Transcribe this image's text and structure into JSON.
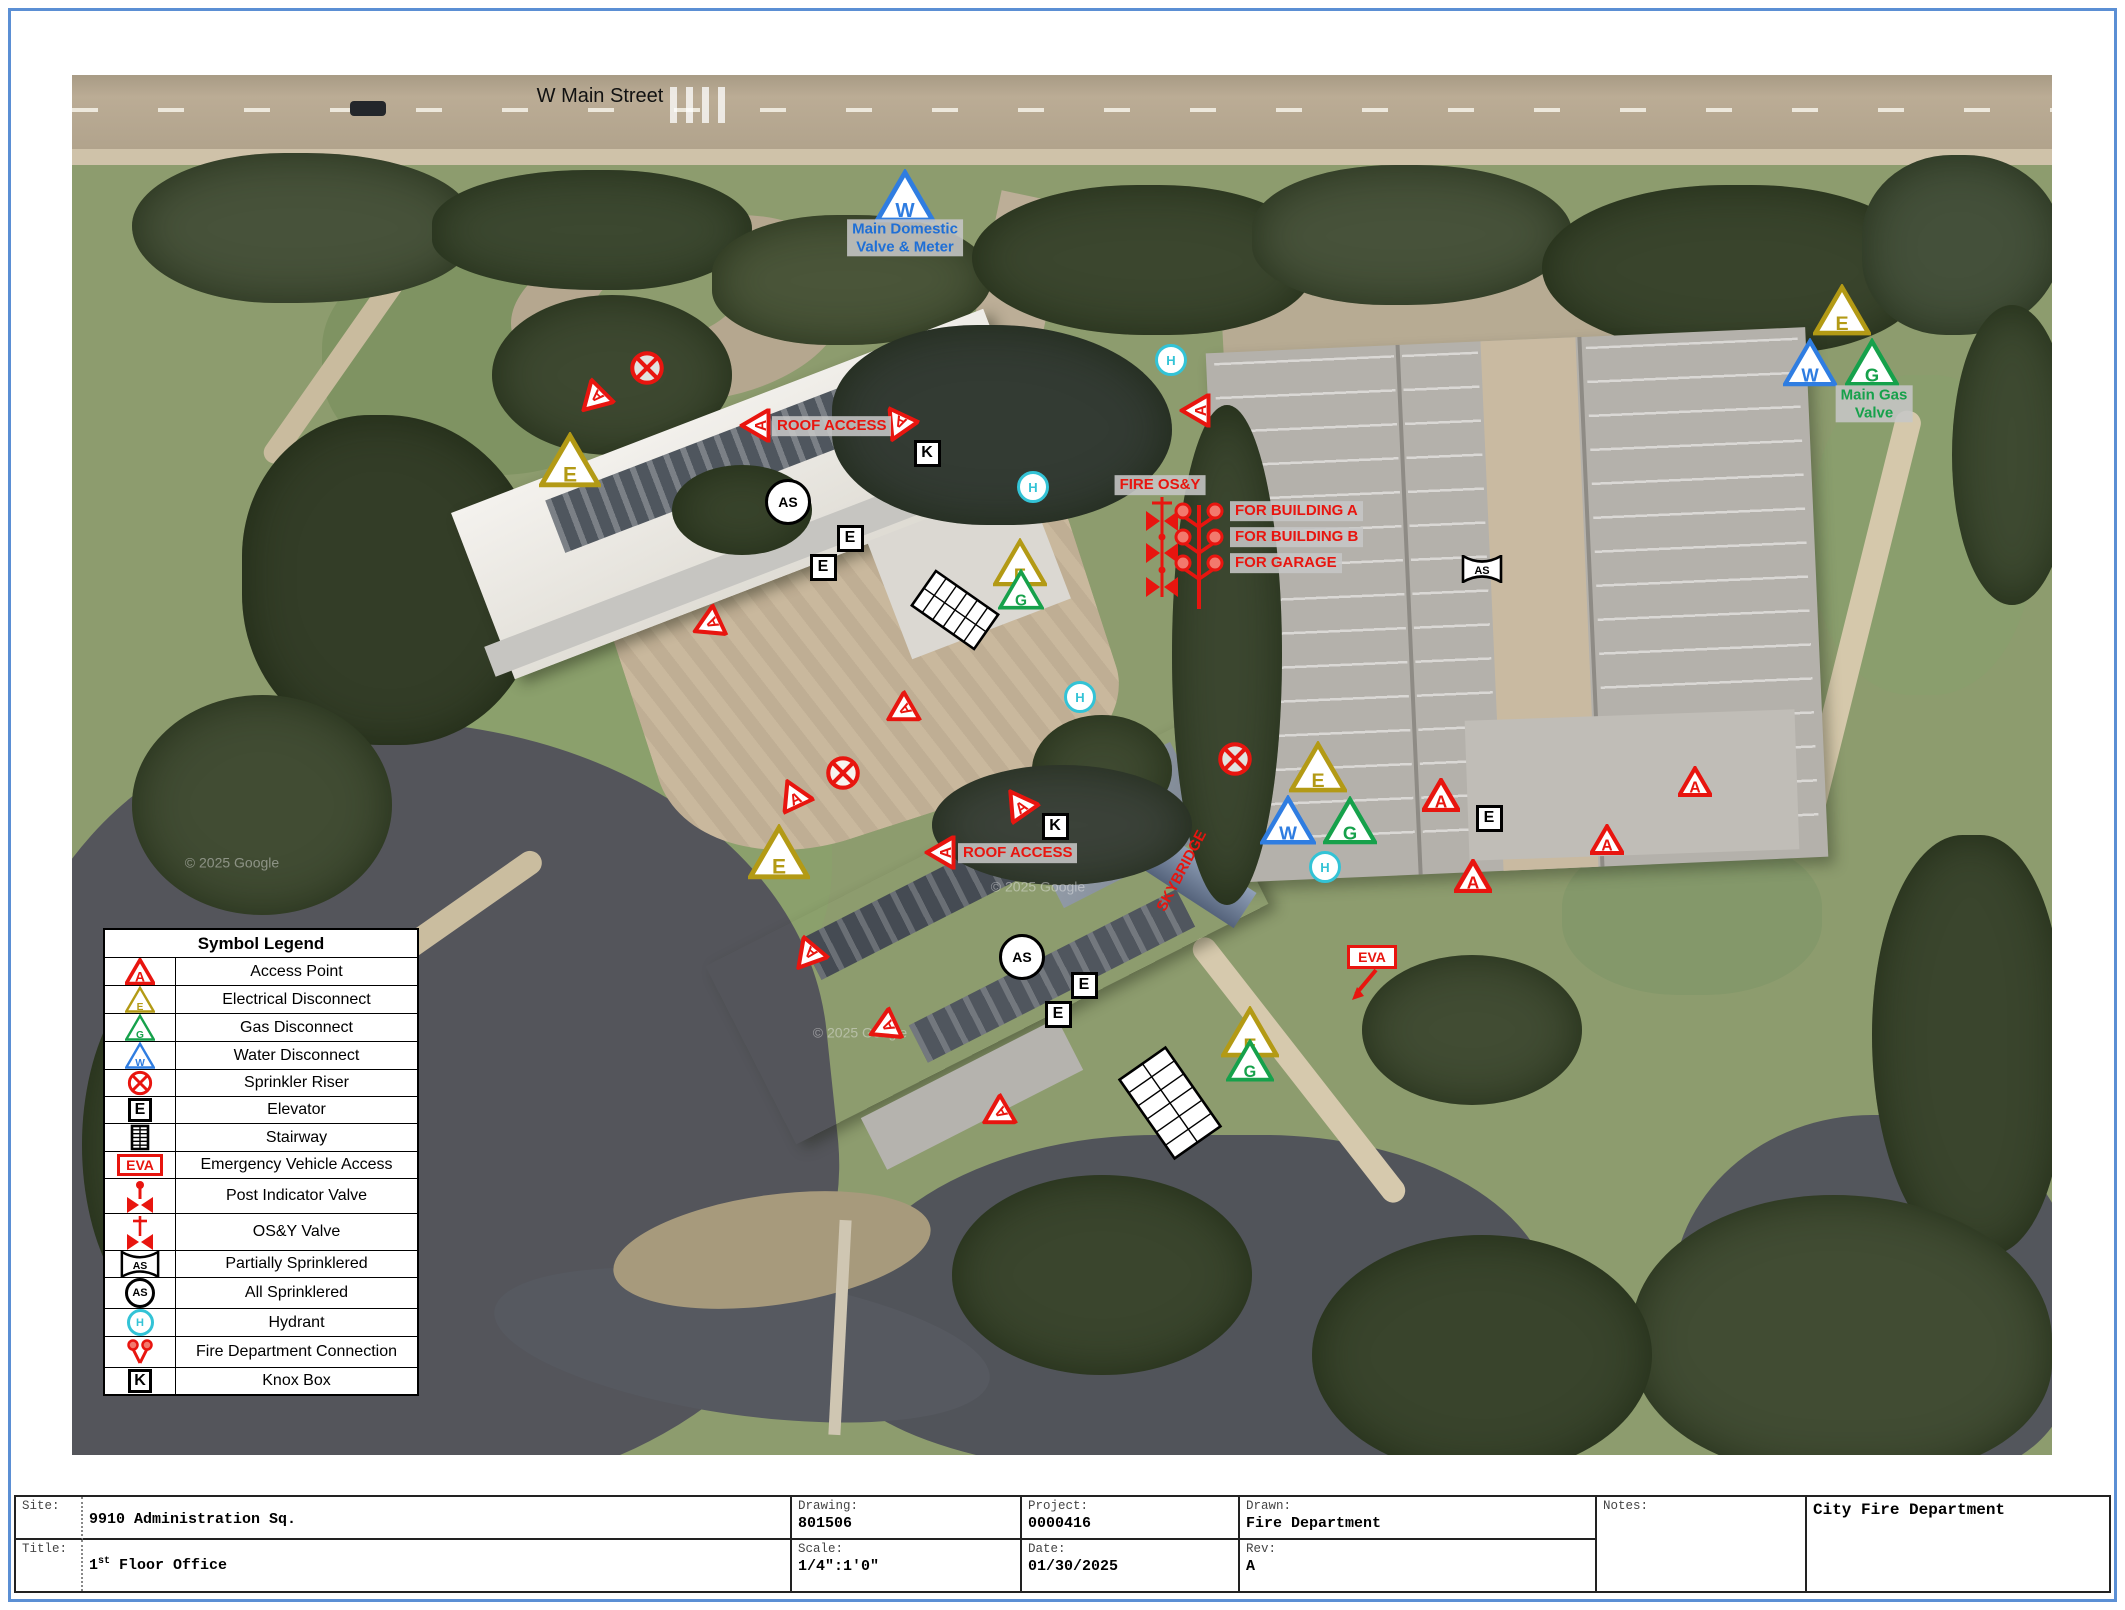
{
  "street": {
    "label": "W Main Street"
  },
  "legend": {
    "title": "Symbol Legend",
    "rows": [
      {
        "icon": "tri",
        "letter": "A",
        "color": "red",
        "label": "Access Point"
      },
      {
        "icon": "tri",
        "letter": "E",
        "color": "yellow",
        "label": "Electrical Disconnect"
      },
      {
        "icon": "tri",
        "letter": "G",
        "color": "green",
        "label": "Gas Disconnect"
      },
      {
        "icon": "tri",
        "letter": "W",
        "color": "blue",
        "label": "Water Disconnect"
      },
      {
        "icon": "riser",
        "label": "Sprinkler Riser"
      },
      {
        "icon": "box",
        "letter": "E",
        "label": "Elevator"
      },
      {
        "icon": "stair",
        "label": "Stairway"
      },
      {
        "icon": "eva",
        "letter": "EVA",
        "label": "Emergency Vehicle Access"
      },
      {
        "icon": "piv",
        "label": "Post Indicator Valve"
      },
      {
        "icon": "osy",
        "label": "OS&Y Valve"
      },
      {
        "icon": "bowtieAS",
        "letter": "AS",
        "label": "Partially Sprinklered"
      },
      {
        "icon": "circleAS",
        "letter": "AS",
        "label": "All Sprinklered"
      },
      {
        "icon": "hyd",
        "letter": "H",
        "label": "Hydrant"
      },
      {
        "icon": "fdc",
        "label": "Fire Department Connection"
      },
      {
        "icon": "box",
        "letter": "K",
        "label": "Knox Box"
      }
    ]
  },
  "map": {
    "colors": {
      "red": "#e8150f",
      "yellow": "#b39a15",
      "green": "#16a14b",
      "blue": "#2f7de1",
      "cyan": "#33c3d6",
      "label_blue": "#1f6fd6",
      "label_bg": "#c6c6c6",
      "black": "#111111",
      "wm": "rgba(235,235,235,0.45)"
    },
    "markers": [
      {
        "t": "tri",
        "l": "W",
        "c": "blue",
        "x": 833,
        "y": 121,
        "s": 60
      },
      {
        "t": "hyd",
        "l": "H",
        "x": 1099,
        "y": 285
      },
      {
        "t": "tri",
        "l": "A",
        "c": "red",
        "x": 1123,
        "y": 335,
        "s": 34,
        "r": -90
      },
      {
        "t": "riser",
        "x": 575,
        "y": 293
      },
      {
        "t": "tri",
        "l": "A",
        "c": "red",
        "x": 521,
        "y": 325,
        "s": 34,
        "r": -135
      },
      {
        "t": "tri",
        "l": "E",
        "c": "yellow",
        "x": 498,
        "y": 385,
        "s": 62
      },
      {
        "t": "tri",
        "l": "A",
        "c": "red",
        "x": 683,
        "y": 350,
        "s": 34,
        "r": -90
      },
      {
        "t": "tri",
        "l": "A",
        "c": "red",
        "x": 826,
        "y": 352,
        "s": 34,
        "r": -155
      },
      {
        "t": "box",
        "l": "K",
        "x": 855,
        "y": 378
      },
      {
        "t": "circleAS",
        "l": "AS",
        "x": 716,
        "y": 427
      },
      {
        "t": "hyd",
        "l": "H",
        "x": 961,
        "y": 412
      },
      {
        "t": "box",
        "l": "E",
        "x": 778,
        "y": 463
      },
      {
        "t": "box",
        "l": "E",
        "x": 751,
        "y": 492
      },
      {
        "t": "tri",
        "l": "E",
        "c": "yellow",
        "x": 948,
        "y": 487,
        "s": 54
      },
      {
        "t": "tri",
        "l": "G",
        "c": "green",
        "x": 949,
        "y": 514,
        "s": 46
      },
      {
        "t": "stair",
        "x": 883,
        "y": 535,
        "w": 46,
        "h": 80,
        "r": -55
      },
      {
        "t": "tri",
        "l": "A",
        "c": "red",
        "x": 635,
        "y": 550,
        "s": 34,
        "r": -115
      },
      {
        "t": "hyd",
        "l": "H",
        "x": 1008,
        "y": 622
      },
      {
        "t": "tri",
        "l": "A",
        "c": "red",
        "x": 828,
        "y": 637,
        "s": 34,
        "r": -120
      },
      {
        "t": "fireosy",
        "x": 1090,
        "y": 472
      },
      {
        "t": "fdctree",
        "x": 1127,
        "y": 482
      },
      {
        "t": "bowtieAS",
        "l": "AS",
        "x": 1410,
        "y": 494
      },
      {
        "t": "riser",
        "x": 1163,
        "y": 684
      },
      {
        "t": "tri",
        "l": "E",
        "c": "yellow",
        "x": 1246,
        "y": 692,
        "s": 58
      },
      {
        "t": "tri",
        "l": "W",
        "c": "blue",
        "x": 1216,
        "y": 745,
        "s": 56
      },
      {
        "t": "tri",
        "l": "G",
        "c": "green",
        "x": 1278,
        "y": 745,
        "s": 54
      },
      {
        "t": "tri",
        "l": "A",
        "c": "red",
        "x": 1369,
        "y": 720,
        "s": 38
      },
      {
        "t": "box",
        "l": "E",
        "x": 1417,
        "y": 743
      },
      {
        "t": "tri",
        "l": "A",
        "c": "red",
        "x": 1623,
        "y": 706,
        "s": 34
      },
      {
        "t": "tri",
        "l": "A",
        "c": "red",
        "x": 1535,
        "y": 764,
        "s": 34
      },
      {
        "t": "tri",
        "l": "A",
        "c": "red",
        "x": 1401,
        "y": 801,
        "s": 38
      },
      {
        "t": "hyd",
        "l": "H",
        "x": 1253,
        "y": 792
      },
      {
        "t": "eva",
        "l": "EVA",
        "x": 1300,
        "y": 882
      },
      {
        "t": "tri",
        "l": "E",
        "c": "yellow",
        "x": 1770,
        "y": 235,
        "s": 58
      },
      {
        "t": "tri",
        "l": "W",
        "c": "blue",
        "x": 1738,
        "y": 287,
        "s": 54
      },
      {
        "t": "tri",
        "l": "G",
        "c": "green",
        "x": 1800,
        "y": 287,
        "s": 54
      },
      {
        "t": "riser",
        "x": 771,
        "y": 698
      },
      {
        "t": "tri",
        "l": "A",
        "c": "red",
        "x": 721,
        "y": 718,
        "s": 34,
        "r": -25
      },
      {
        "t": "tri",
        "l": "A",
        "c": "red",
        "x": 946,
        "y": 727,
        "s": 34,
        "r": -35
      },
      {
        "t": "box",
        "l": "K",
        "x": 983,
        "y": 751
      },
      {
        "t": "tri",
        "l": "A",
        "c": "red",
        "x": 868,
        "y": 777,
        "s": 34,
        "r": -90
      },
      {
        "t": "tri",
        "l": "E",
        "c": "yellow",
        "x": 707,
        "y": 777,
        "s": 62
      },
      {
        "t": "circleAS",
        "l": "AS",
        "x": 950,
        "y": 882
      },
      {
        "t": "tri",
        "l": "A",
        "c": "red",
        "x": 735,
        "y": 882,
        "s": 34,
        "r": -140
      },
      {
        "t": "box",
        "l": "E",
        "x": 1012,
        "y": 910
      },
      {
        "t": "box",
        "l": "E",
        "x": 986,
        "y": 939
      },
      {
        "t": "tri",
        "l": "A",
        "c": "red",
        "x": 811,
        "y": 953,
        "s": 34,
        "r": -115
      },
      {
        "t": "tri",
        "l": "A",
        "c": "red",
        "x": 924,
        "y": 1040,
        "s": 34,
        "r": -120
      },
      {
        "t": "tri",
        "l": "E",
        "c": "yellow",
        "x": 1178,
        "y": 957,
        "s": 58
      },
      {
        "t": "tri",
        "l": "G",
        "c": "green",
        "x": 1178,
        "y": 985,
        "s": 48
      },
      {
        "t": "stair",
        "x": 1098,
        "y": 1028,
        "w": 60,
        "h": 100,
        "r": -35
      }
    ],
    "labels": [
      {
        "name": "street-name-label",
        "text": "W Main Street",
        "x": 528,
        "y": 22,
        "cls": "street",
        "color": "black"
      },
      {
        "name": "main-domestic-valve-label",
        "lines": [
          "Main Domestic",
          "Valve & Meter"
        ],
        "x": 833,
        "y": 163,
        "color": "label_blue",
        "bg": true
      },
      {
        "name": "fire-osy-label",
        "text": "FIRE OS&Y",
        "x": 1088,
        "y": 410,
        "color": "red",
        "bg": true
      },
      {
        "name": "fdc-building-a-label",
        "text": "FOR BUILDING A",
        "x": 1158,
        "y": 436,
        "color": "red",
        "bg": true,
        "align": "left"
      },
      {
        "name": "fdc-building-b-label",
        "text": "FOR BUILDING B",
        "x": 1158,
        "y": 462,
        "color": "red",
        "bg": true,
        "align": "left"
      },
      {
        "name": "fdc-garage-label",
        "text": "FOR GARAGE",
        "x": 1158,
        "y": 488,
        "color": "red",
        "bg": true,
        "align": "left"
      },
      {
        "name": "roof-access-label-a",
        "text": "ROOF ACCESS",
        "x": 700,
        "y": 351,
        "color": "red",
        "bg": true,
        "align": "left"
      },
      {
        "name": "roof-access-label-b",
        "text": "ROOF ACCESS",
        "x": 886,
        "y": 778,
        "color": "red",
        "bg": true,
        "align": "left"
      },
      {
        "name": "skybridge-label",
        "text": "SKYBRIDGE",
        "x": 1110,
        "y": 796,
        "color": "red",
        "rot": -62
      },
      {
        "name": "main-gas-valve-label",
        "lines": [
          "Main Gas",
          "Valve"
        ],
        "x": 1802,
        "y": 329,
        "color": "green",
        "bg": true
      },
      {
        "name": "google-watermark",
        "text": "© 2025 Google",
        "x": 160,
        "y": 788,
        "cls": "wm",
        "color": "wm"
      },
      {
        "name": "google-watermark",
        "text": "© 2025 Google",
        "x": 966,
        "y": 812,
        "cls": "wm",
        "color": "wm"
      },
      {
        "name": "google-watermark",
        "text": "© 2025 Google",
        "x": 788,
        "y": 958,
        "cls": "wm",
        "color": "wm"
      }
    ]
  },
  "title_block": {
    "site_label": "Site:",
    "site_value": "9910 Administration Sq.",
    "title_label": "Title:",
    "title_value": {
      "num": "1",
      "sup": "st",
      "rest": " Floor Office"
    },
    "drawing_label": "Drawing:",
    "drawing_value": "801506",
    "scale_label": "Scale:",
    "scale_value": "1/4\":1'0\"",
    "project_label": "Project:",
    "project_value": "0000416",
    "date_label": "Date:",
    "date_value": "01/30/2025",
    "drawn_label": "Drawn:",
    "drawn_value": "Fire Department",
    "rev_label": "Rev:",
    "rev_value": "A",
    "notes_label": "Notes:",
    "org_value": "City Fire Department"
  }
}
